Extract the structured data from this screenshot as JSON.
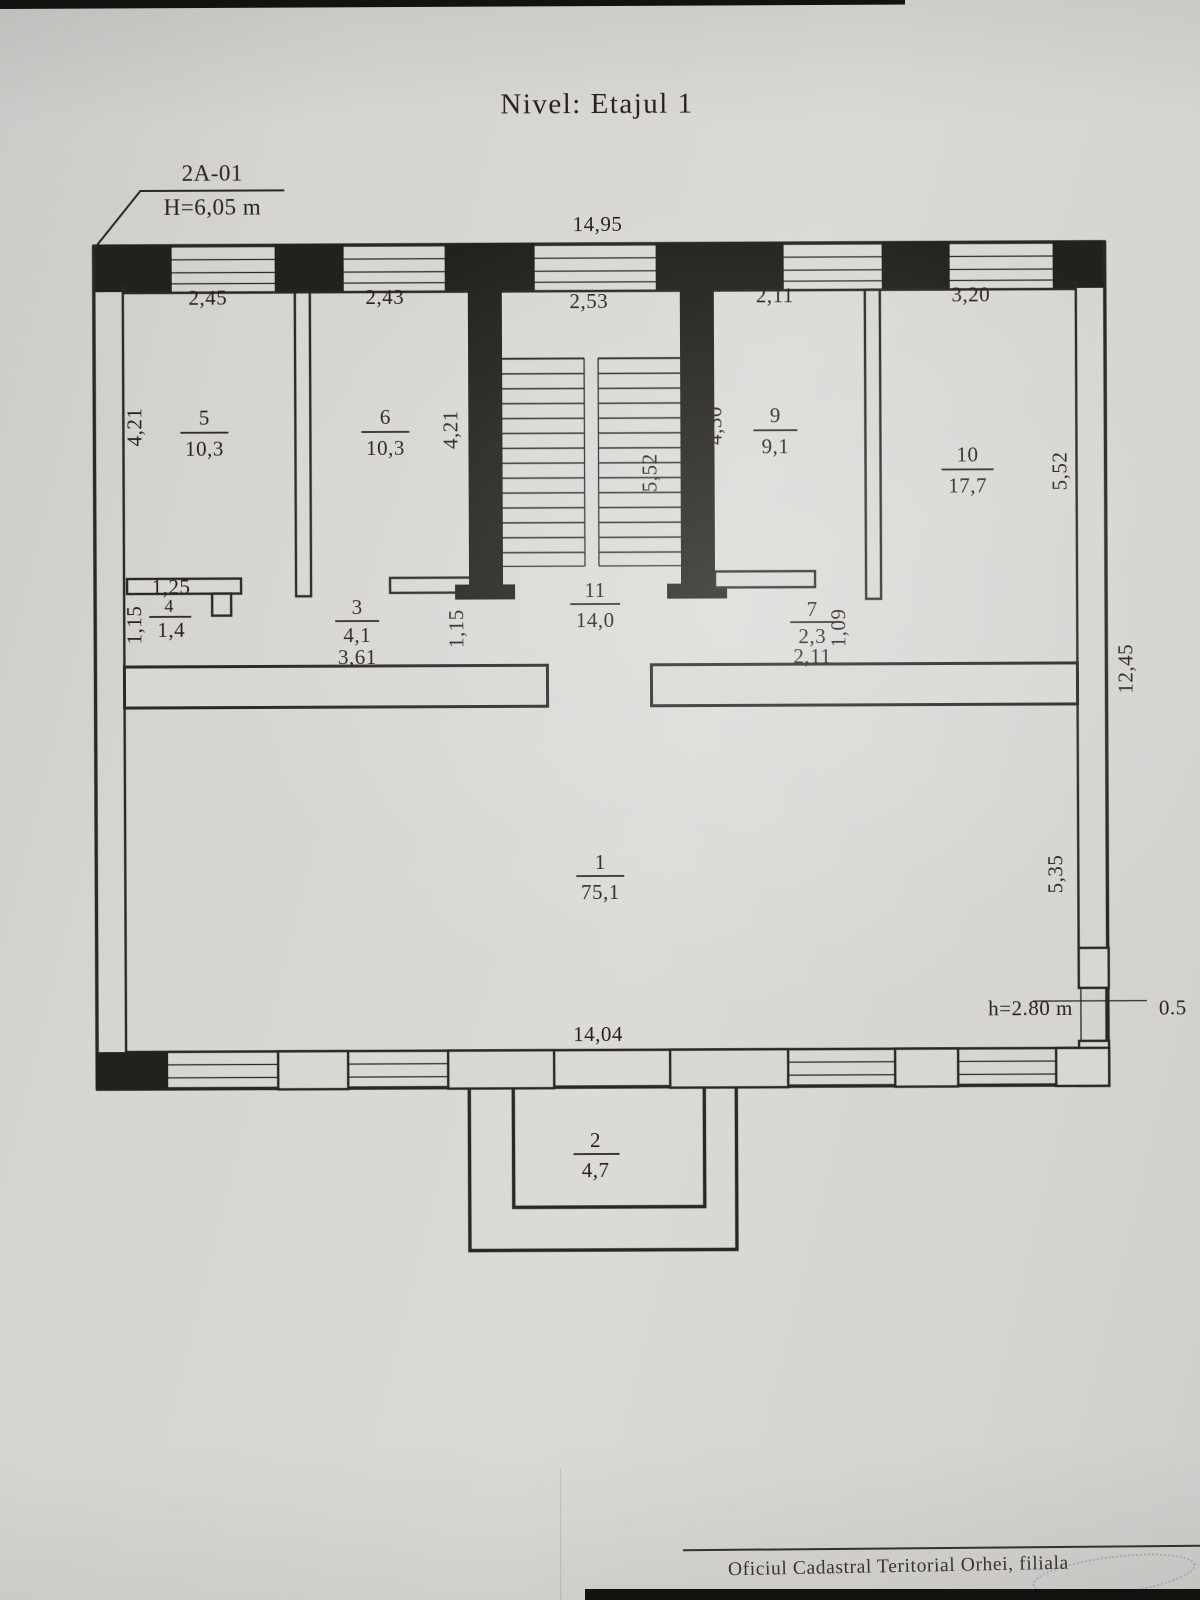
{
  "colors": {
    "paper": "#d8d7d3",
    "ink": "#23211c"
  },
  "plan": {
    "title": "Nivel: Etajul 1",
    "callout": {
      "code": "2A-01",
      "height": "H=6,05 m"
    },
    "overall_dims": {
      "top_width": "14,95",
      "bottom_width": "14,04",
      "right_total_height": "12,45",
      "right_upper_height": "5,52",
      "right_lower_height": "5,35",
      "door_height_note": "h=2.80 m",
      "door_width": "0.5"
    },
    "top_room_widths": {
      "room5": "2,45",
      "room6": "2,43",
      "stairwell": "2,53",
      "room9": "2,11",
      "room10": "3,20"
    },
    "side_dims": {
      "room5_height": "4,21",
      "room6_height": "4,21",
      "stairwell_height": "5,52",
      "room9_height": "4,30",
      "room4_height": "1,15",
      "corridor_left_height": "1,15",
      "room7_height": "1,09"
    },
    "rooms": {
      "r1": {
        "no": "1",
        "area": "75,1"
      },
      "r2": {
        "no": "2",
        "area": "4,7"
      },
      "r3": {
        "no": "3",
        "area": "4,1",
        "width": "3,61"
      },
      "r4": {
        "no": "4",
        "area": "1,4",
        "width": "1,25"
      },
      "r5": {
        "no": "5",
        "area": "10,3"
      },
      "r6": {
        "no": "6",
        "area": "10,3"
      },
      "r7": {
        "no": "7",
        "area": "2,3",
        "width": "2,11"
      },
      "r9": {
        "no": "9",
        "area": "9,1"
      },
      "r10": {
        "no": "10",
        "area": "17,7"
      },
      "r11": {
        "no": "11",
        "area": "14,0"
      }
    },
    "footer": "Oficiul Cadastral Teritorial Orhei, filiala"
  }
}
